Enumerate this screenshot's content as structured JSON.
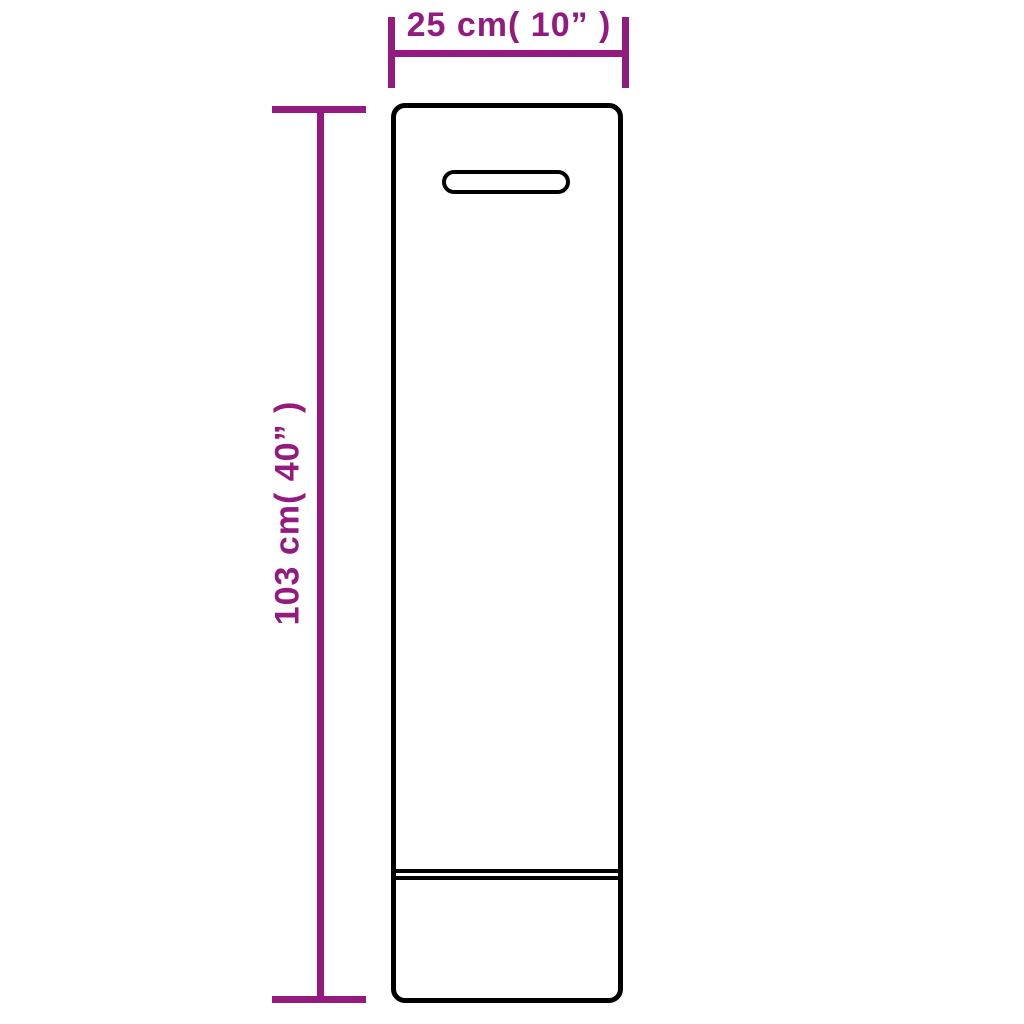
{
  "dimensions": {
    "width_label": "25 cm( 10” )",
    "height_label": "103 cm( 40” )"
  },
  "shapes": {
    "bag_outline": "tall rounded rectangle",
    "handle_slot": "pill-shaped cutout near top",
    "seam": "double horizontal line near bottom"
  },
  "colors": {
    "dimension_accent": "#931b80",
    "outline": "#000000",
    "background": "#ffffff"
  }
}
